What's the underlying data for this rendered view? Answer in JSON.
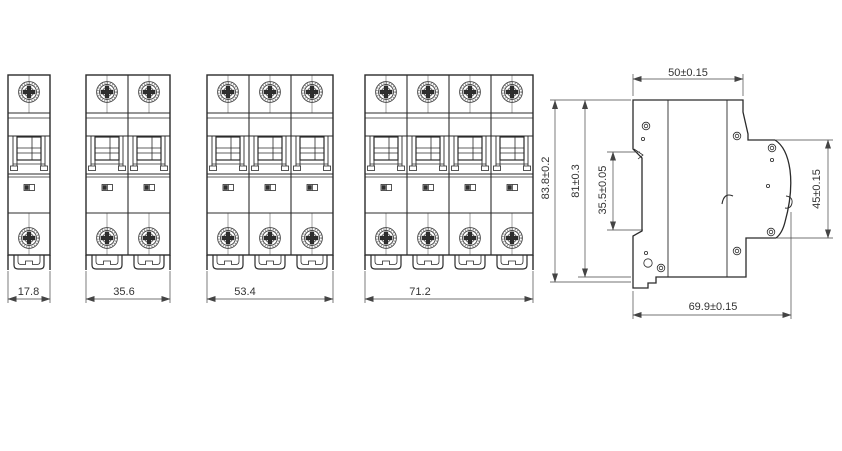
{
  "page": {
    "background": "#ffffff",
    "line_color": "#2b2b2b",
    "dim_line_color": "#444444",
    "text_color": "#333333",
    "screw_shade_color": "#8a8a8a",
    "indicator_fill_color": "#2f2f2f"
  },
  "views": {
    "front": [
      {
        "name": "1-pole breaker front view",
        "poles": 1,
        "width_label": "17.8"
      },
      {
        "name": "2-pole breaker front view",
        "poles": 2,
        "width_label": "35.6"
      },
      {
        "name": "3-pole breaker front view",
        "poles": 3,
        "width_label": "53.4"
      },
      {
        "name": "4-pole breaker front view",
        "poles": 4,
        "width_label": "71.2"
      }
    ],
    "side": {
      "name": "breaker side profile view",
      "top_depth_label": "50±0.15",
      "overall_height_label": "83.8±0.2",
      "body_height_label": "81±0.3",
      "din_slot_label": "35.5±0.05",
      "front_face_label": "45±0.15",
      "overall_depth_label": "69.9±0.15"
    }
  }
}
